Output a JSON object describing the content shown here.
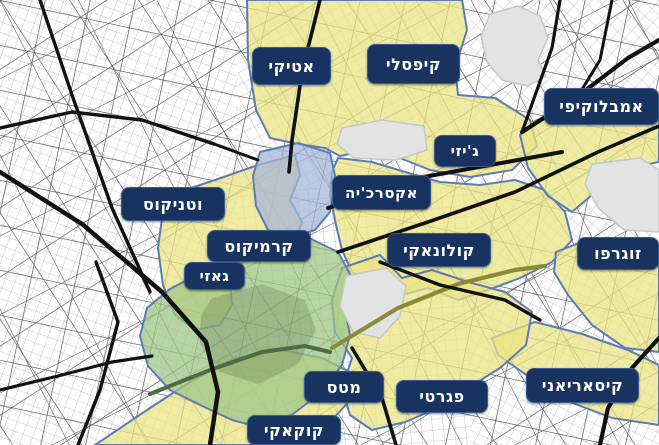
{
  "map": {
    "colors": {
      "background": "#ffffff",
      "badge_bg": "#18335f",
      "badge_text": "#ffffff",
      "region_border": "#5d7bb4",
      "region_yellow": "rgba(233,228,130,0.74)",
      "region_green": "rgba(158,197,134,0.74)",
      "region_blue": "rgba(165,182,216,0.74)",
      "park_fill": "#e3e3e3",
      "park_stroke": "#c6c6c6",
      "hill_fill": "rgba(88,116,66,0.28)",
      "road_major": "#111111",
      "road_olive": "#8a8a38",
      "road_green_tint": "#4f6b45",
      "street_thin": "#b4b4b4",
      "street_medium": "#3a3a3a"
    },
    "districts": [
      {
        "id": "attiki",
        "label": "אטיקי",
        "x": 252,
        "y": 47,
        "w": 79,
        "h": 38,
        "fs": 16
      },
      {
        "id": "kypseli",
        "label": "קיפסלי",
        "x": 367,
        "y": 44,
        "w": 93,
        "h": 40,
        "fs": 16
      },
      {
        "id": "ambelokipi",
        "label": "אמבלוקיפי",
        "x": 544,
        "y": 88,
        "w": 115,
        "h": 37,
        "fs": 16
      },
      {
        "id": "gyzi",
        "label": "ג'יזי",
        "x": 434,
        "y": 135,
        "w": 62,
        "h": 32,
        "fs": 15
      },
      {
        "id": "exarcheia",
        "label": "אקסרכ'יה",
        "x": 332,
        "y": 175,
        "w": 99,
        "h": 35,
        "fs": 15
      },
      {
        "id": "votanikos",
        "label": "וטניקוס",
        "x": 121,
        "y": 187,
        "w": 104,
        "h": 34,
        "fs": 16
      },
      {
        "id": "kerameikos",
        "label": "קרמיקוס",
        "x": 207,
        "y": 230,
        "w": 104,
        "h": 32,
        "fs": 16
      },
      {
        "id": "gazi",
        "label": "גאזי",
        "x": 184,
        "y": 262,
        "w": 61,
        "h": 28,
        "fs": 15
      },
      {
        "id": "kolonaki",
        "label": "קולונאקי",
        "x": 387,
        "y": 233,
        "w": 104,
        "h": 34,
        "fs": 16
      },
      {
        "id": "zografou",
        "label": "זוגרפו",
        "x": 577,
        "y": 237,
        "w": 82,
        "h": 33,
        "fs": 16
      },
      {
        "id": "mets",
        "label": "מטס",
        "x": 304,
        "y": 371,
        "w": 80,
        "h": 32,
        "fs": 16
      },
      {
        "id": "pangrati",
        "label": "פגרטי",
        "x": 396,
        "y": 380,
        "w": 92,
        "h": 33,
        "fs": 16
      },
      {
        "id": "kaisariani",
        "label": "קיסאריאני",
        "x": 526,
        "y": 368,
        "w": 113,
        "h": 35,
        "fs": 16
      },
      {
        "id": "koukaki",
        "label": "קוקאקי",
        "x": 247,
        "y": 415,
        "w": 94,
        "h": 30,
        "fs": 16
      }
    ],
    "regions": [
      {
        "id": "votanikos-kerameikos-gazi",
        "fill": "region_yellow",
        "points": "170,195 215,180 258,165 295,155 300,175 290,200 302,222 295,240 265,252 243,262 230,280 232,305 220,325 195,330 175,315 163,285 158,248 162,218"
      },
      {
        "id": "attiki-kypseli-gyzi",
        "fill": "region_yellow",
        "points": "247,0 462,0 467,30 455,68 458,95 495,98 530,120 537,146 512,170 470,177 430,170 400,158 368,150 340,156 325,148 298,144 270,138 256,110 248,60"
      },
      {
        "id": "exarcheia-kolonaki",
        "fill": "region_yellow",
        "points": "338,158 372,162 405,172 440,182 480,185 515,180 545,190 565,212 572,240 552,262 520,278 488,290 458,300 428,288 402,295 378,285 352,272 342,250 336,225 330,195 332,172"
      },
      {
        "id": "ambelokipi",
        "fill": "region_yellow",
        "points": "520,135 558,108 598,92 632,92 659,102 659,162 628,168 600,188 572,212 548,196 528,168"
      },
      {
        "id": "zografou",
        "fill": "region_yellow",
        "points": "556,252 592,238 630,242 659,248 659,352 625,348 592,325 568,295 554,272"
      },
      {
        "id": "kaisariani",
        "fill": "region_yellow",
        "points": "492,338 535,322 582,334 628,350 659,365 659,425 612,418 565,400 522,372 498,355"
      },
      {
        "id": "pangrati-mets",
        "fill": "region_yellow",
        "points": "342,268 380,255 402,278 432,270 468,282 505,292 532,312 526,345 500,368 468,388 438,408 405,422 372,430 350,415 342,388 352,358 335,332 332,300"
      },
      {
        "id": "koukaki",
        "fill": "region_yellow",
        "points": "95,445 150,408 190,382 235,358 282,350 322,358 350,372 352,398 332,420 305,438 285,445"
      },
      {
        "id": "historic-center-green",
        "fill": "region_green",
        "points": "235,262 268,244 305,236 338,252 350,274 344,305 350,335 342,365 322,392 293,414 262,428 232,420 198,404 170,390 148,366 140,336 147,308 170,289 202,272"
      },
      {
        "id": "city-center-blue",
        "fill": "region_blue",
        "points": "260,152 298,143 330,153 336,180 330,212 315,230 292,237 268,230 256,206 253,176"
      }
    ],
    "parks": [
      {
        "id": "lycabettus-hill",
        "points": "490,14 518,6 540,16 548,38 538,60 546,76 528,86 502,80 487,62 481,36"
      },
      {
        "id": "areos-park",
        "points": "342,128 382,120 424,126 427,150 396,160 354,158 337,144"
      },
      {
        "id": "national-garden",
        "points": "346,276 386,268 406,286 400,316 380,338 353,332 340,306"
      },
      {
        "id": "campus-area",
        "points": "592,164 640,158 659,170 659,232 624,230 598,208 585,184"
      }
    ],
    "hill": {
      "id": "acropolis-hill",
      "points": "212,298 262,284 305,300 316,330 298,364 258,384 220,372 200,344 201,316"
    },
    "roads": {
      "major": [
        {
          "d": "M0,172 L82,224 L162,292 L206,342 L218,392 L210,445",
          "w": 4.5
        },
        {
          "d": "M40,0 L72,95 L112,208 L150,292",
          "w": 3.4
        },
        {
          "d": "M0,128 L72,112 L142,120 L214,144",
          "w": 3.4
        },
        {
          "d": "M320,0 L302,72 L292,140 L289,172",
          "w": 3.6
        },
        {
          "d": "M328,208 L418,178 L518,160 L562,152",
          "w": 4.0
        },
        {
          "d": "M522,132 L578,96 L628,58 L659,40",
          "w": 4.2
        },
        {
          "d": "M338,252 L428,222 L515,192 L598,152 L659,126",
          "w": 3.6
        },
        {
          "d": "M380,262 L440,285 L505,300 L540,320",
          "w": 3.4
        },
        {
          "d": "M659,338 L632,368 L608,408 L600,445",
          "w": 4.2
        },
        {
          "d": "M96,262 L118,322 L100,390 L78,445",
          "w": 3.4
        },
        {
          "d": "M0,390 L58,376 L112,362 L152,356",
          "w": 3.2
        },
        {
          "d": "M560,0 L552,48 L522,132",
          "w": 3.2
        },
        {
          "d": "M612,0 L600,60 L578,96",
          "w": 3.0
        },
        {
          "d": "M352,348 L382,398 L396,445",
          "w": 3.6
        },
        {
          "d": "M214,144 L258,160",
          "w": 3.0
        }
      ],
      "tinted": [
        {
          "d": "M332,348 L398,308 L458,284 L515,270 L545,266",
          "w": 4.2,
          "color": "road_olive"
        },
        {
          "d": "M150,394 L210,370 L262,352 L305,346 L330,352",
          "w": 4.0,
          "color": "road_green_tint"
        }
      ]
    },
    "grid_zones": [
      {
        "points": "0,0 238,0 238,445 0,445",
        "rot": 20,
        "size": 10
      },
      {
        "points": "238,0 470,0 470,188 238,188",
        "rot": -28,
        "size": 11
      },
      {
        "points": "470,0 659,0 659,252 470,252",
        "rot": 42,
        "size": 10
      },
      {
        "points": "238,188 470,188 470,445 238,445",
        "rot": -6,
        "size": 11
      },
      {
        "points": "470,252 659,252 659,445 470,445",
        "rot": 26,
        "size": 10
      }
    ],
    "grid_medium": [
      {
        "size": 44,
        "rot": 12,
        "w": 1.3
      },
      {
        "size": 58,
        "rot": -33,
        "w": 1.2
      },
      {
        "size": 70,
        "rot": 63,
        "w": 1.0
      }
    ]
  }
}
